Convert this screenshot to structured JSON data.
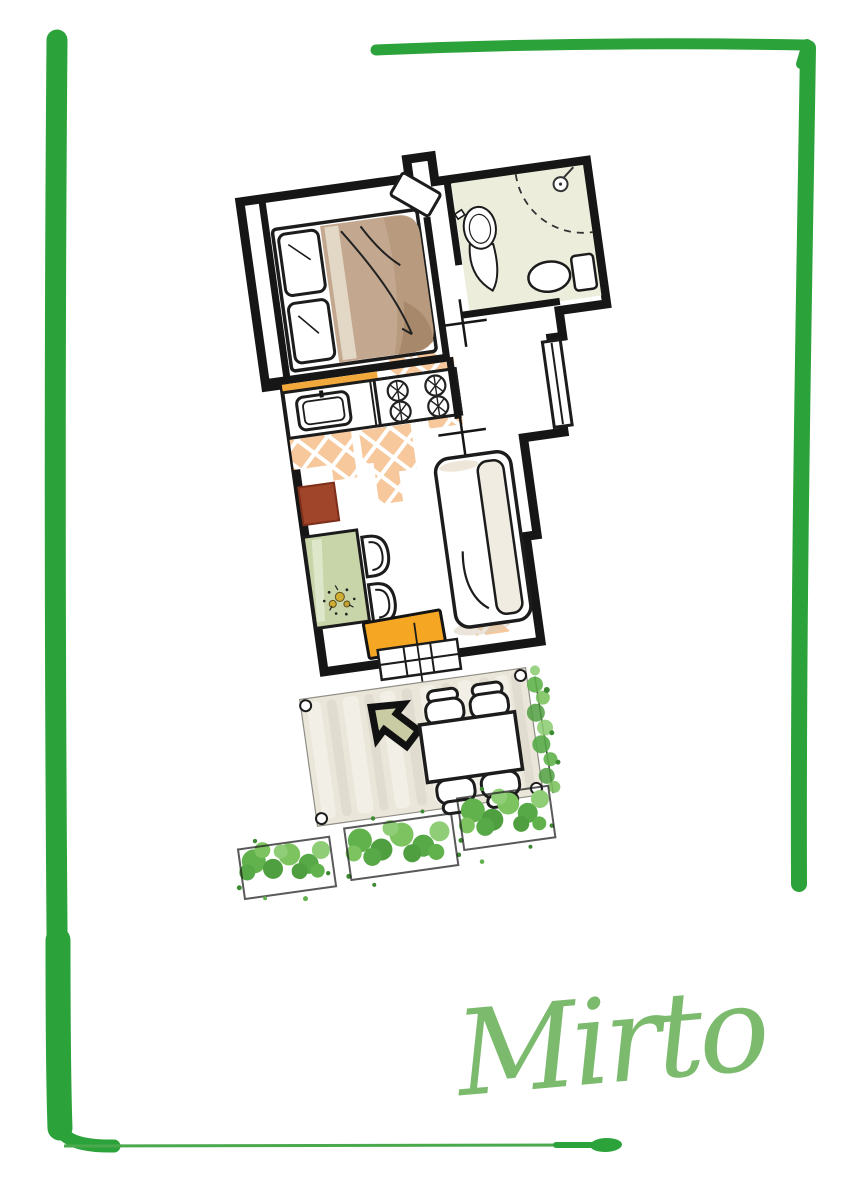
{
  "signature": {
    "text": "Mirto"
  },
  "icons": [
    {
      "name": "entrance-arrow-icon",
      "meaning": "arrow pointing toward apartment entrance door",
      "shape": "thick black outlined arrow, olive fill, pointing up-left"
    }
  ],
  "depicted_elements": [
    "hand-drawn green border frame",
    "apartment floor plan rotated slightly counterclockwise",
    "bedroom with double bed, two pillows, tan duvet, open door leaf",
    "bathroom with pedestal sink, dashed shower enclosure, toilet",
    "kitchen counter with sink and four-burner stove, orange backsplash",
    "orange lattice tile floor patches",
    "living area with red-brown stool, sage green table with flower motif, two chairs, white sofa with cushion, orange mat",
    "entrance french door with grid panes",
    "outdoor deck with corner posts, entrance arrow, table with four chairs",
    "green hedges and three planter boxes",
    "green script signature reading Mirto"
  ],
  "colors": {
    "frame_green": "#2ca33a",
    "bottom_line_green": "#4aa94d",
    "script_green": "#7cbb6e",
    "wall_black": "#161616",
    "tile_orange": "#f6c89b",
    "backsplash_orange": "#f2a93b",
    "bath_floor": "#eceedb",
    "duvet_tan": "#c3a88f",
    "duvet_shadow": "#a8886a",
    "table_sage": "#c8d5a8",
    "stool_red": "#a0442a",
    "mat_orange": "#f5a623",
    "arrow_olive": "#c9cba3",
    "deck_beige": "#eae6da",
    "deck_stripe_light": "#f3f0e8",
    "deck_stripe_dark": "#e1dccf",
    "bush_green": "#61b24c",
    "bush_dark": "#3e8a33",
    "bush_light": "#8fce77",
    "sofa_cushion": "#f1ece1"
  }
}
